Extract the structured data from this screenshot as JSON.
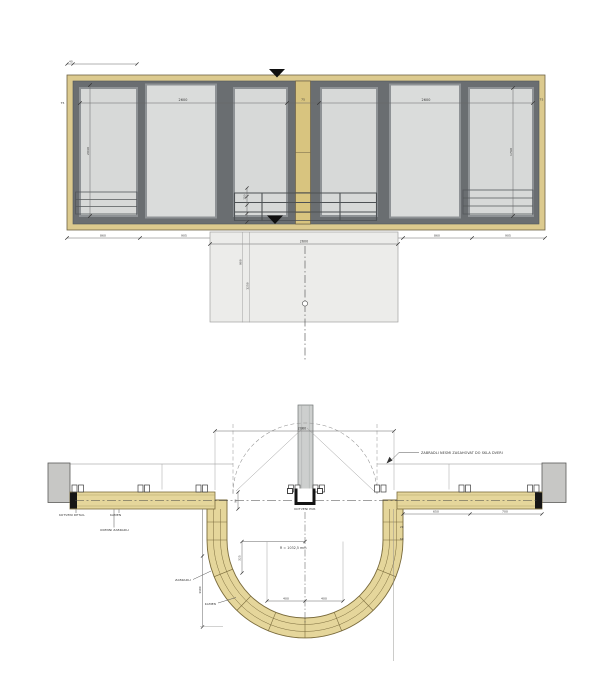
{
  "colors": {
    "wood_frame": "#dcca8e",
    "wood_post": "#d8c47f",
    "wood_plan": "#e5d69b",
    "window_frame": "#6a6e71",
    "glass": "#d7d9d8",
    "slab": "#ececea",
    "wall": "#c7c7c5",
    "ink": "#3f3f3f"
  },
  "elevation": {
    "dim_group_left": "2600",
    "dim_group_right": "2600",
    "dim_height_left": "2040",
    "dim_height_right": "1760",
    "dim_post_width": "75",
    "dim_frame_left": "75",
    "dim_frame_right": "75",
    "dim_top_offset": "40",
    "dim_rail": "150",
    "chain": [
      "860",
      "905",
      "760",
      "300",
      "905",
      "860",
      "905"
    ],
    "slab": {
      "dim_width": "2600",
      "dim_v1": "900",
      "dim_v2": "1250"
    }
  },
  "plan": {
    "dim_opening": "2060",
    "note": "ZABRADLI NESMI ZASAHOVAT DO SKLA DVERI",
    "labels": {
      "sill_flashing": "KOTVENI DETAIL",
      "stone": "KAMEN",
      "window_railing": "OKENNI ZABRADLI",
      "railing": "ZABRADLI",
      "stone_ring": "KAMEN",
      "anchor": "KOTVENI PUR"
    },
    "dims": {
      "radius": "R = 1032,5 mm",
      "inner_left": "400",
      "inner_right": "400",
      "radius_drop": "325",
      "depth": "1180",
      "right_1": "650",
      "right_2": "700",
      "lam_1": "20",
      "lam_2": "60",
      "center_offset": "90"
    }
  }
}
